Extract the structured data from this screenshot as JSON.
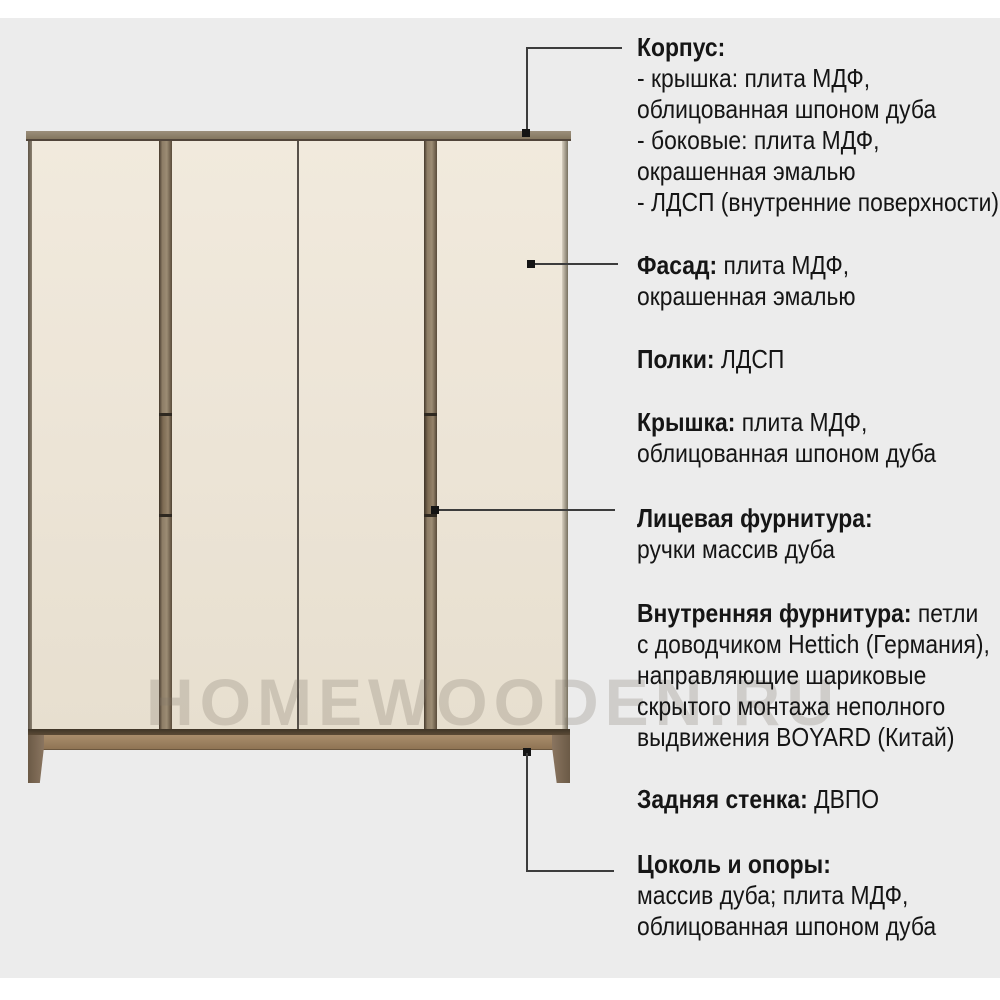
{
  "watermark": "HOMEWOODEN.RU",
  "colors": {
    "background": "#ececec",
    "door_panel": "#ece5d7",
    "wood_mid": "#8b7b64",
    "wood_dark": "#4a3e2f",
    "plinth": "#9a8164",
    "connector_line": "#3c3c3c",
    "text": "#151515",
    "watermark": "#80776b"
  },
  "annotations": [
    {
      "id": "korpus",
      "lines": [
        [
          {
            "b": true,
            "t": "Корпус:"
          }
        ],
        [
          {
            "t": "- крышка: плита МДФ,"
          }
        ],
        [
          {
            "t": "облицованная шпоном дуба"
          }
        ],
        [
          {
            "t": "- боковые: плита МДФ,"
          }
        ],
        [
          {
            "t": "окрашенная эмалью"
          }
        ],
        [
          {
            "t": "- ЛДСП (внутренние поверхности)"
          }
        ]
      ]
    },
    {
      "id": "fasad",
      "lines": [
        [
          {
            "b": true,
            "t": "Фасад:"
          },
          {
            "t": " плита МДФ,"
          }
        ],
        [
          {
            "t": "окрашенная эмалью"
          }
        ]
      ]
    },
    {
      "id": "polki",
      "lines": [
        [
          {
            "b": true,
            "t": "Полки:"
          },
          {
            "t": " ЛДСП"
          }
        ]
      ]
    },
    {
      "id": "kryshka",
      "lines": [
        [
          {
            "b": true,
            "t": "Крышка:"
          },
          {
            "t": " плита МДФ,"
          }
        ],
        [
          {
            "t": "облицованная шпоном дуба"
          }
        ]
      ]
    },
    {
      "id": "licevaya-furnitura",
      "lines": [
        [
          {
            "b": true,
            "t": "Лицевая фурнитура:"
          }
        ],
        [
          {
            "t": "ручки массив дуба"
          }
        ]
      ]
    },
    {
      "id": "vnutrennyaya-furnitura",
      "lines": [
        [
          {
            "b": true,
            "t": "Внутренняя фурнитура:"
          },
          {
            "t": " петли"
          }
        ],
        [
          {
            "t": "с доводчиком Hettich (Германия),"
          }
        ],
        [
          {
            "t": "направляющие шариковые"
          }
        ],
        [
          {
            "t": "скрытого монтажа неполного"
          }
        ],
        [
          {
            "t": "выдвижения BOYARD (Китай)"
          }
        ]
      ]
    },
    {
      "id": "zadnyaya-stenka",
      "lines": [
        [
          {
            "b": true,
            "t": "Задняя стенка:"
          },
          {
            "t": " ДВПО"
          }
        ]
      ]
    },
    {
      "id": "cokol-i-opory",
      "lines": [
        [
          {
            "b": true,
            "t": "Цоколь и опоры:"
          }
        ],
        [
          {
            "t": "массив дуба; плита МДФ,"
          }
        ],
        [
          {
            "t": "облицованная шпоном дуба"
          }
        ]
      ]
    }
  ]
}
